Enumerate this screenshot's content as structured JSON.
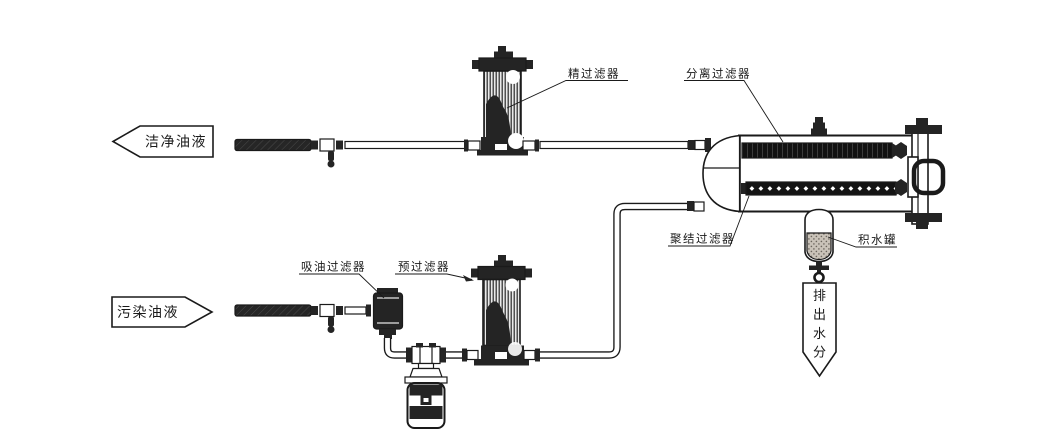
{
  "diagram": {
    "type": "oil-purification-system-schematic",
    "labels": {
      "clean_oil": "洁净油液",
      "contaminated_oil": "污染油液",
      "fine_filter": "精过滤器",
      "separation_filter": "分离过滤器",
      "coalescing_filter": "聚结过滤器",
      "suction_filter": "吸油过滤器",
      "pre_filter": "预过滤器",
      "water_tank": "积水罐",
      "discharge_chars": [
        "排",
        "出",
        "水",
        "分"
      ]
    }
  },
  "colors": {
    "ink": "#1a1a1a",
    "dark": "#242424",
    "paper": "#ffffff",
    "hose_fill": "#262626",
    "water_fill": "#c9c2b8"
  }
}
